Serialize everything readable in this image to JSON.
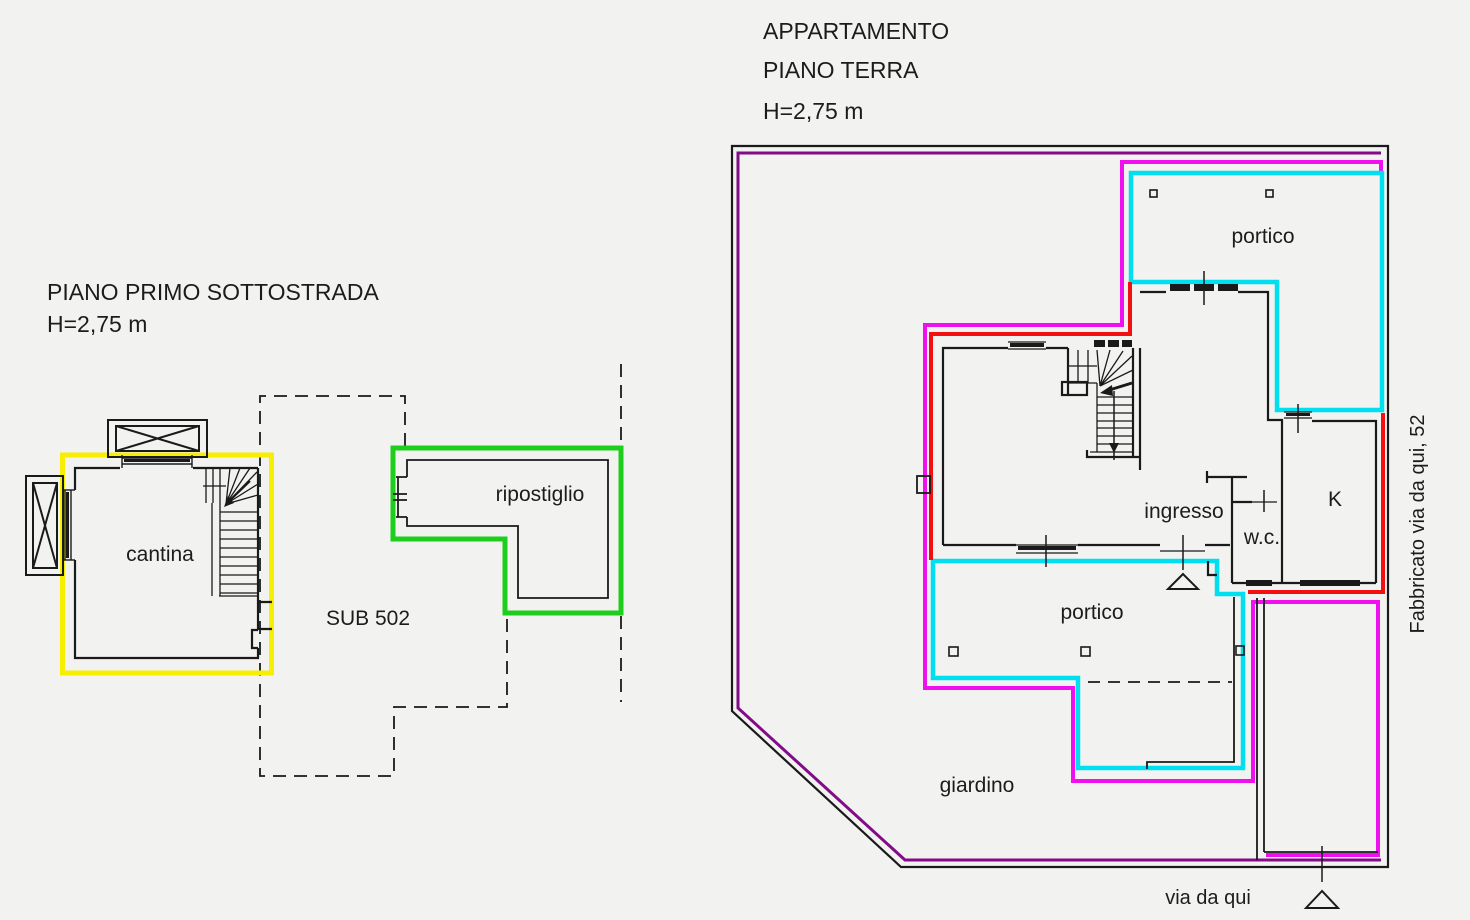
{
  "colors": {
    "background": "#f2f2f1",
    "wall": "#1a1a1a",
    "yellow": "#f8ee00",
    "green": "#1dce1d",
    "cyan": "#00dff0",
    "magenta": "#ef0fef",
    "red": "#f21010",
    "purple": "#830b88"
  },
  "left_plan": {
    "title": "PIANO PRIMO SOTTOSTRADA",
    "height_label": "H=2,75 m",
    "room_cantina": "cantina",
    "room_ripostiglio": "ripostiglio",
    "sub_label": "SUB 502"
  },
  "right_plan": {
    "title": "APPARTAMENTO",
    "subtitle": "PIANO TERRA",
    "height_label": "H=2,75 m",
    "room_portico_top": "portico",
    "room_portico_bottom": "portico",
    "room_ingresso": "ingresso",
    "room_wc": "w.c.",
    "room_kitchen": "K",
    "room_giardino": "giardino",
    "street_label": "via da qui",
    "building_label": "Fabbricato via da qui, 52"
  }
}
